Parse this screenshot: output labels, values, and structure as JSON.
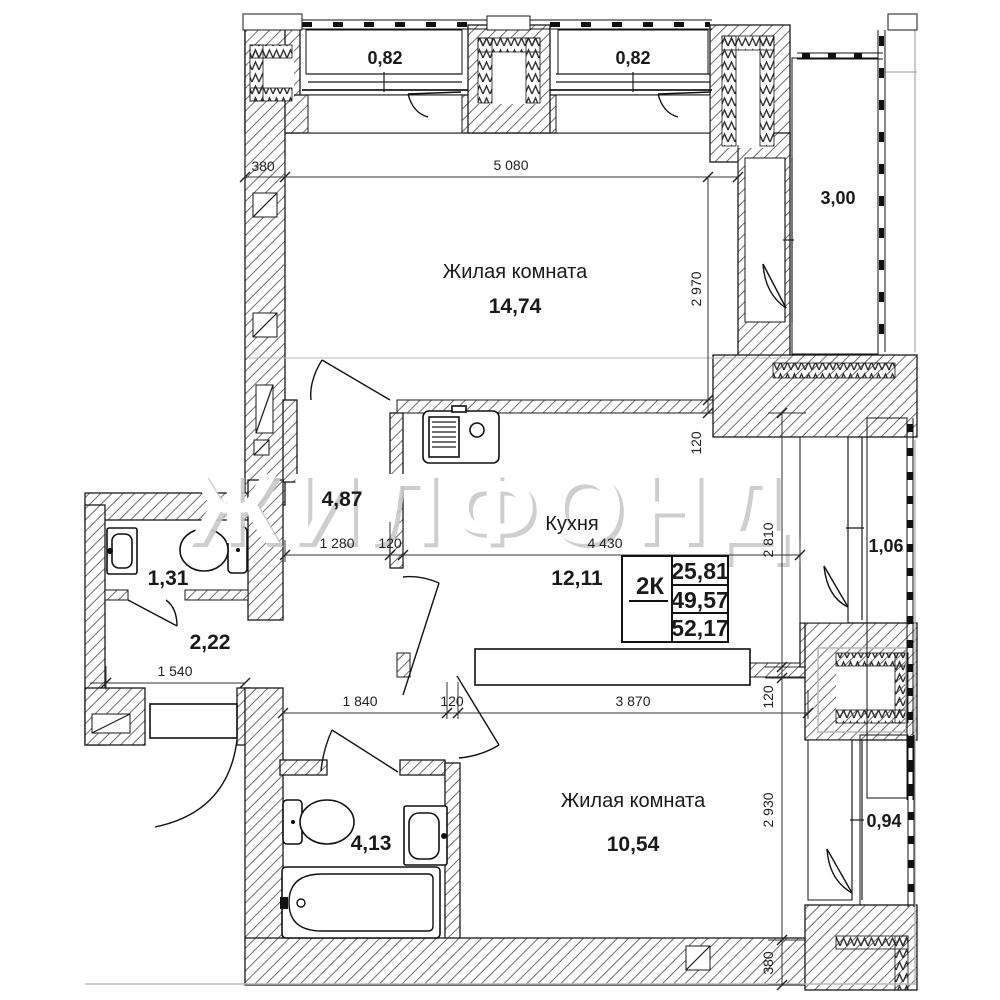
{
  "watermark": "ЖИЛФОНД",
  "rooms": {
    "living1": {
      "name": "Жилая комната",
      "area": "14,74"
    },
    "kitchen": {
      "name": "Кухня",
      "area": "12,11"
    },
    "living2": {
      "name": "Жилая комната",
      "area": "10,54"
    },
    "hall": {
      "area": "4,87"
    },
    "corridor": {
      "area": "2,22"
    },
    "wc": {
      "area": "1,31"
    },
    "bath": {
      "area": "4,13"
    }
  },
  "balconies": {
    "b1": "0,82",
    "b2": "0,82",
    "b3": "3,00",
    "b4": "1,06",
    "b5": "0,94"
  },
  "info_table": {
    "type": "2К",
    "living_area": "25,81",
    "area": "49,57",
    "total_area": "52,17"
  },
  "dims": {
    "wall380": "380",
    "w5080": "5 080",
    "h2970": "2 970",
    "t120a": "120",
    "w1280": "1 280",
    "t120b": "120",
    "w4430": "4 430",
    "h2810": "2 810",
    "t120c": "120",
    "w1540": "1 540",
    "w1840": "1 840",
    "t120d": "120",
    "w3870": "3 870",
    "h2930": "2 930",
    "h380": "380"
  }
}
